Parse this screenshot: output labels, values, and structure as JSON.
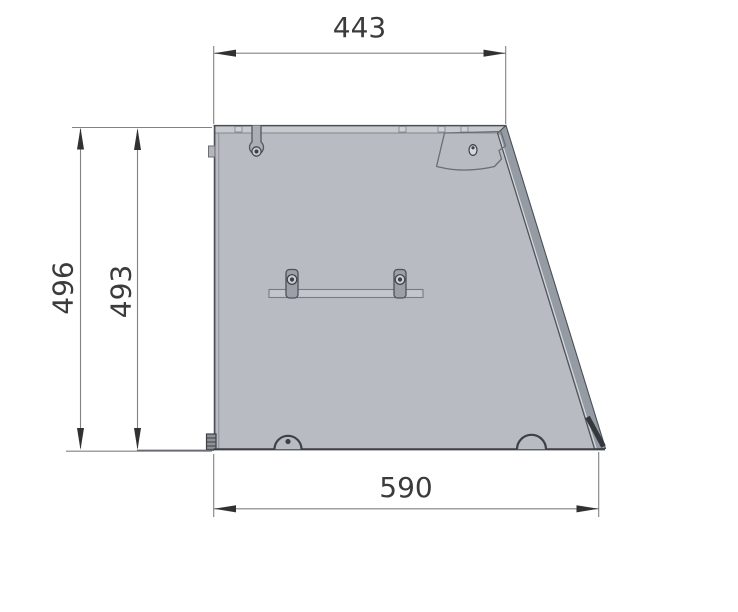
{
  "drawing_type": "technical-panel-side-view",
  "dimensions": {
    "top_width": "443",
    "left_height_outer": "496",
    "left_height_inner": "493",
    "bottom_width": "590"
  },
  "colors": {
    "background": "#ffffff",
    "panel_fill": "#b8bbc1",
    "flange_fill": "#c7cacf",
    "edge_band_fill": "#959ba3",
    "edge_band_dark": "#34383c",
    "outline_dark": "#4b4f55",
    "outline_strong": "#3d4046",
    "detail_fill": "#9ba0a8",
    "screw_fill": "#c9ccd1",
    "dim_line": "#808285",
    "dim_text": "#3b3b3b",
    "arrow": "#2f3133"
  }
}
